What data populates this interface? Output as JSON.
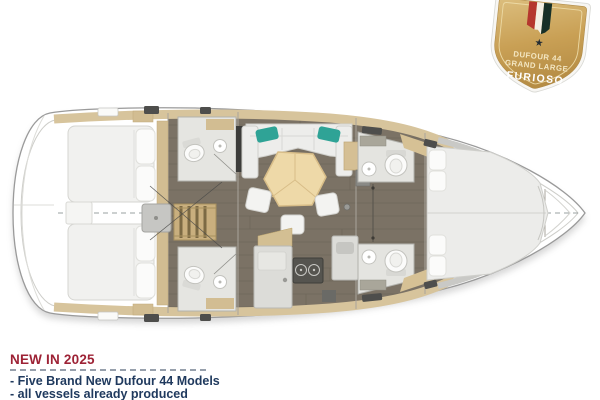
{
  "badge": {
    "model": "DUFOUR 44",
    "range": "GRAND LARGE",
    "edition": "FURIOSO",
    "star_icon": "★"
  },
  "footer": {
    "heading": "NEW IN 2025",
    "bullets": [
      "- Five Brand New Dufour 44 Models",
      "- all vessels already produced",
      "- all D44 ready to deliver by 05.07.2025"
    ]
  },
  "colors": {
    "brand_red": "#9d2235",
    "navy_text": "#203a5e",
    "dash_gray": "#97a0ac",
    "badge_gold": "#c9a055",
    "ribbon_red": "#b5372e",
    "ribbon_white": "#f3efe4",
    "ribbon_green": "#173028",
    "teal_cushion": "#2fa396",
    "wood_tan": "#d7c49c",
    "table_wood": "#eed9a8",
    "floor_brown": "#7b7265"
  }
}
